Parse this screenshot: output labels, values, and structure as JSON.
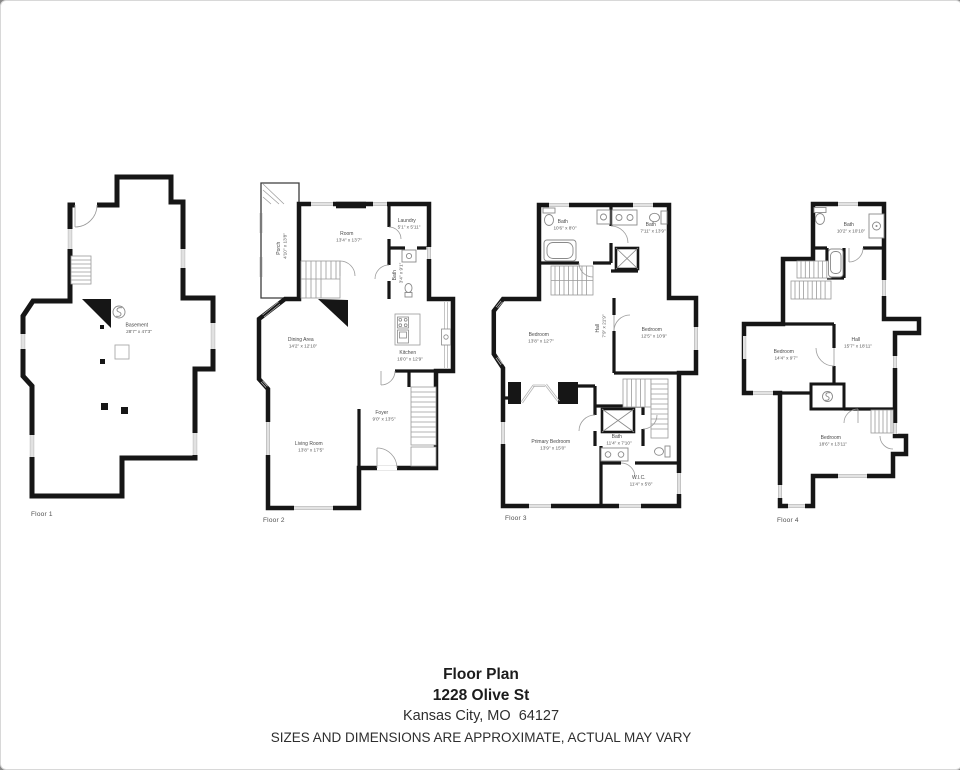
{
  "palette": {
    "wall": "#161616",
    "fixture": "#8a8a8a",
    "window": "#b5b5b5",
    "text": "#4a4a4a"
  },
  "floors": [
    {
      "label": "Floor 1",
      "rooms": [
        {
          "name": "Basement",
          "dims": "28'7\" x 47'3\""
        }
      ]
    },
    {
      "label": "Floor 2",
      "rooms": [
        {
          "name": "Porch",
          "dims": "4'10\" x 13'8\""
        },
        {
          "name": "Room",
          "dims": "13'4\" x 13'7\""
        },
        {
          "name": "Laundry",
          "dims": "5'1\" x 5'11\""
        },
        {
          "name": "Bath",
          "dims": "3'4\" x 9'1\""
        },
        {
          "name": "Dining Area",
          "dims": "14'2\" x 12'10\""
        },
        {
          "name": "Kitchen",
          "dims": "16'0\" x 12'9\""
        },
        {
          "name": "Foyer",
          "dims": "9'0\" x 13'5\""
        },
        {
          "name": "Living Room",
          "dims": "13'8\" x 17'5\""
        }
      ]
    },
    {
      "label": "Floor 3",
      "rooms": [
        {
          "name": "Bath",
          "dims": "10'6\" x 8'0\""
        },
        {
          "name": "Bath",
          "dims": "7'11\" x 13'9\""
        },
        {
          "name": "Bedroom",
          "dims": "13'8\" x 12'7\""
        },
        {
          "name": "Bedroom",
          "dims": "12'5\" x 10'9\""
        },
        {
          "name": "Hall",
          "dims": "7'9\" x 21'9\""
        },
        {
          "name": "Bath",
          "dims": "11'4\" x 7'10\""
        },
        {
          "name": "Primary Bedroom",
          "dims": "13'9\" x 15'0\""
        },
        {
          "name": "W.I.C.",
          "dims": "11'4\" x 5'8\""
        }
      ]
    },
    {
      "label": "Floor 4",
      "rooms": [
        {
          "name": "Bath",
          "dims": "10'2\" x 10'10\""
        },
        {
          "name": "Bedroom",
          "dims": "14'4\" x 9'7\""
        },
        {
          "name": "Hall",
          "dims": "15'7\" x 18'11\""
        },
        {
          "name": "Bedroom",
          "dims": "18'6\" x 13'11\""
        }
      ]
    }
  ],
  "footer": {
    "title": "Floor Plan",
    "address": "1228 Olive St",
    "city": "Kansas City, MO  64127",
    "disclaimer": "SIZES AND DIMENSIONS ARE APPROXIMATE, ACTUAL MAY VARY"
  }
}
